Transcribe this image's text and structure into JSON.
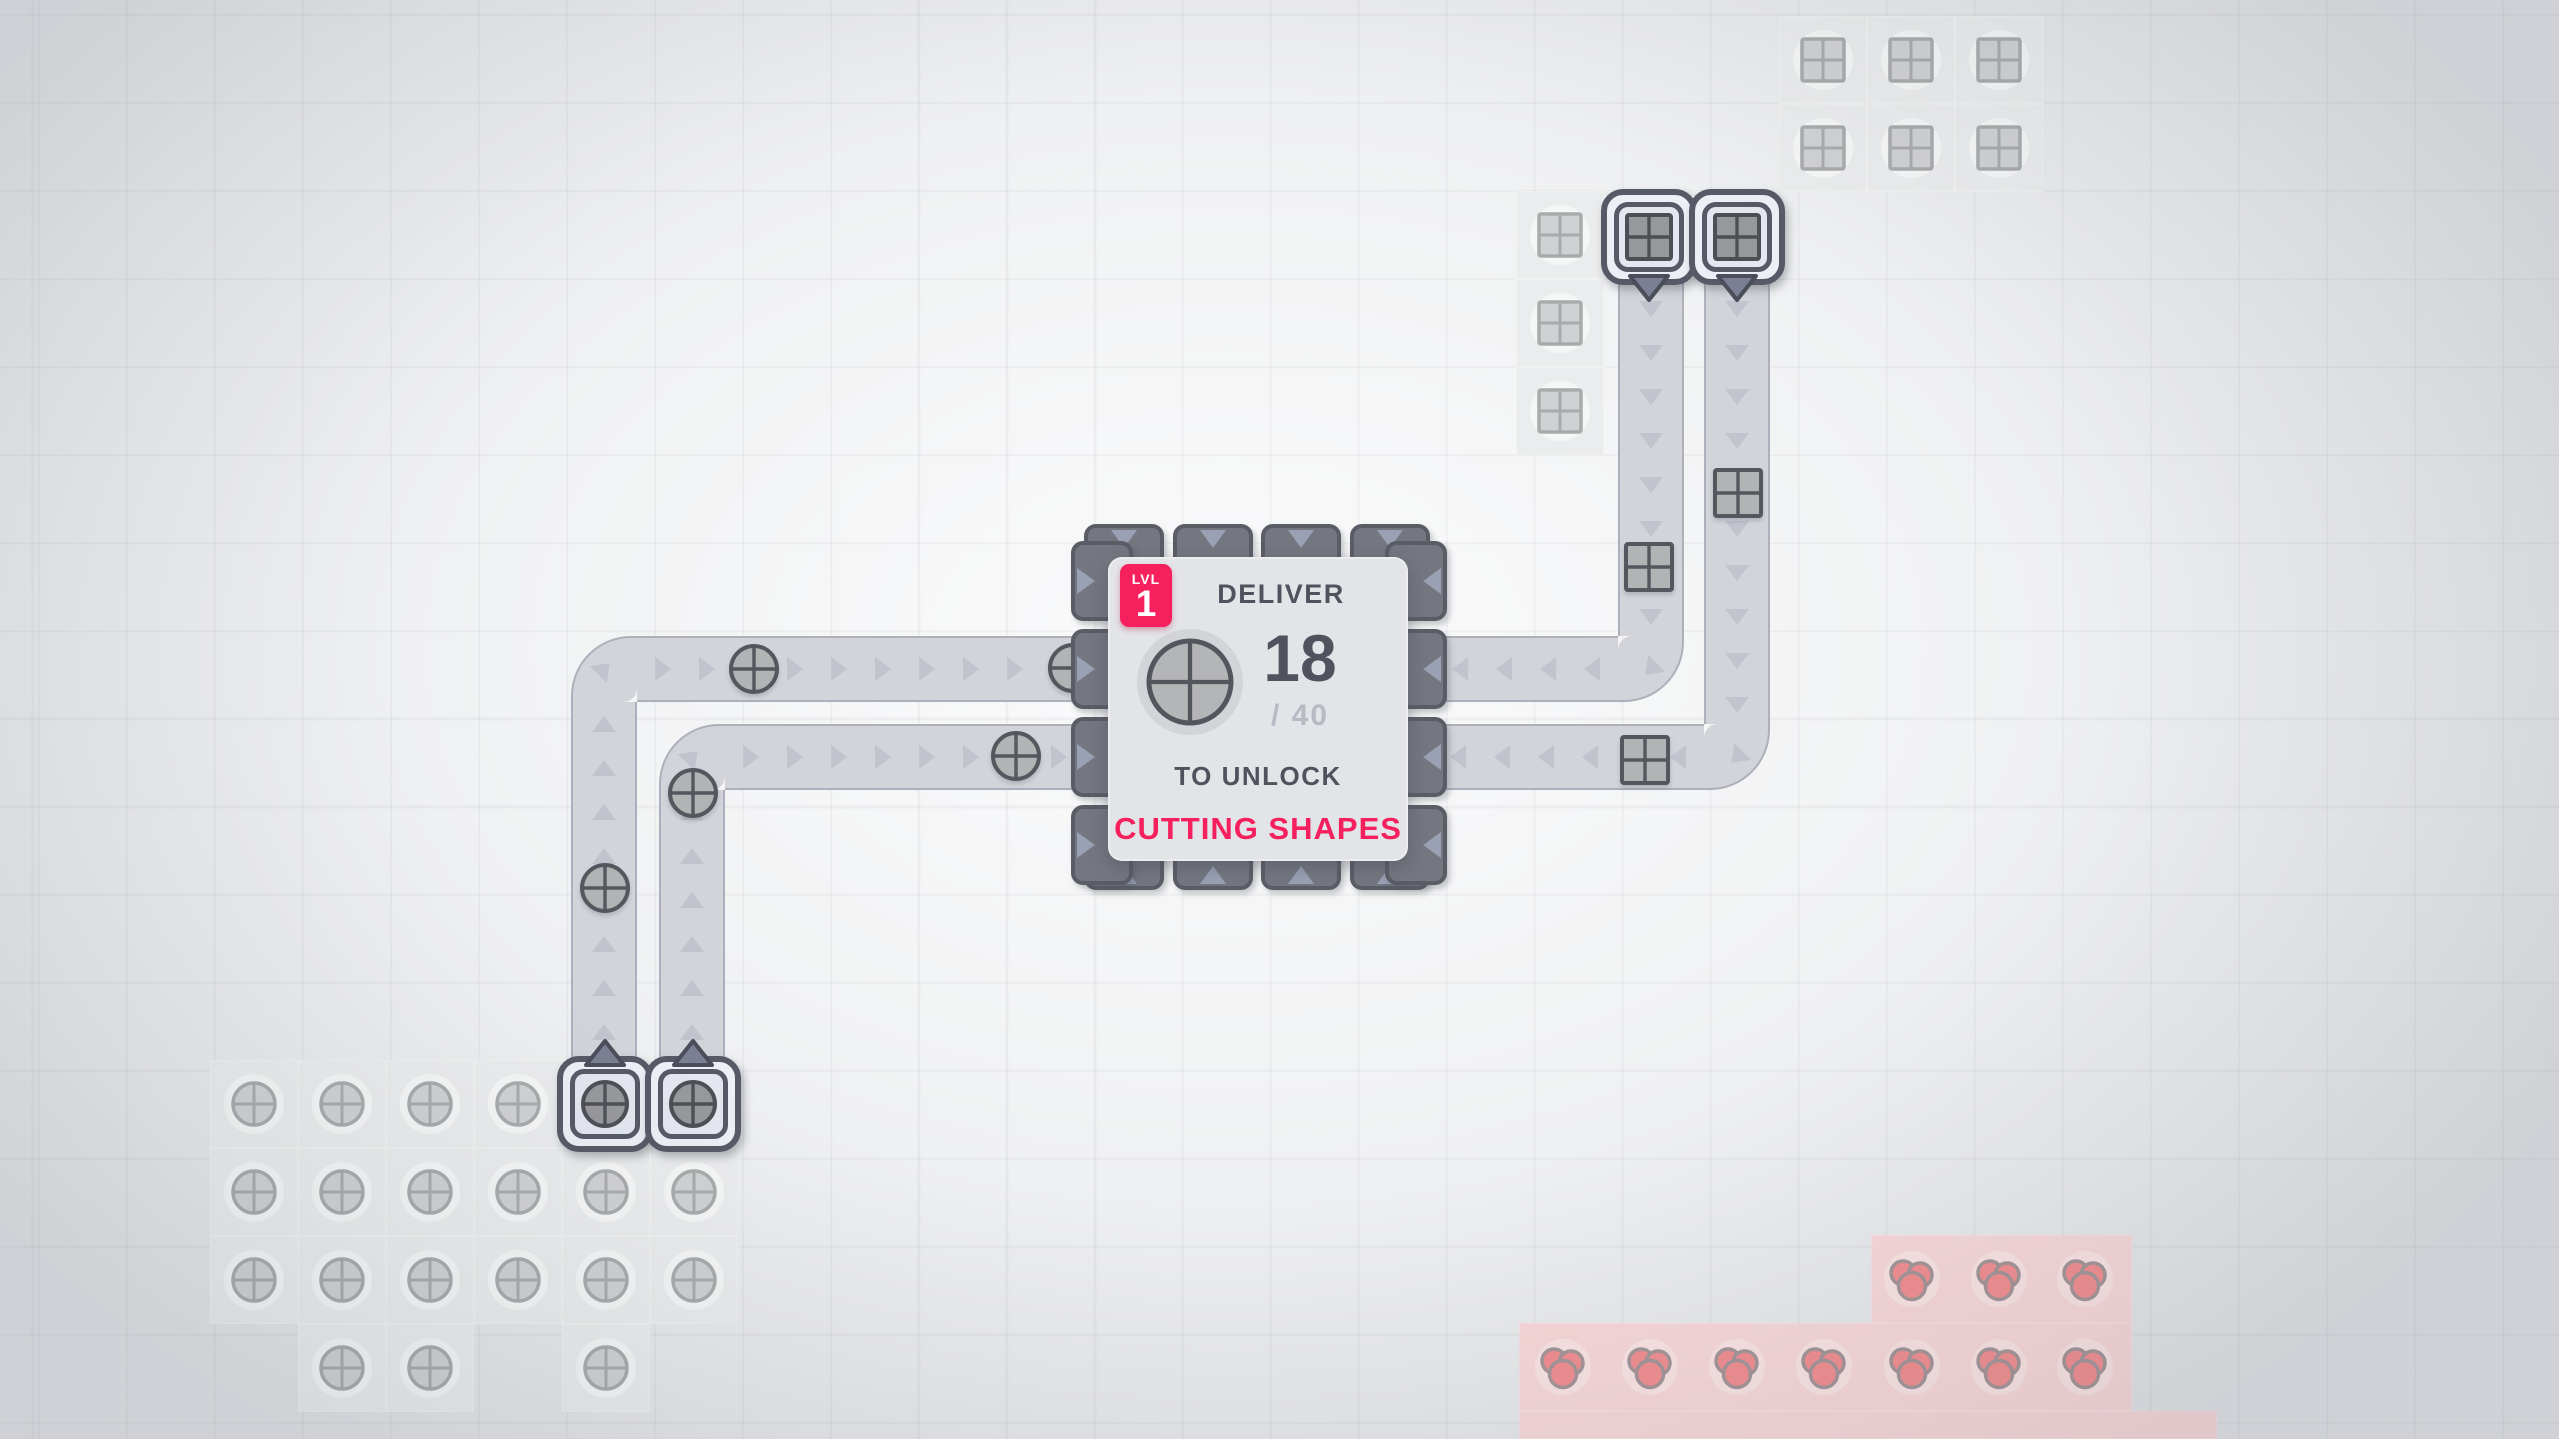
{
  "hub": {
    "level_badge": {
      "label": "LVL",
      "value": "1"
    },
    "title": "DELIVER",
    "delivered": "18",
    "goal": "/ 40",
    "unlock_label": "TO UNLOCK",
    "reward": "CUTTING SHAPES",
    "goal_shape": "circle",
    "panel": {
      "x": 1108,
      "y": 557,
      "w": 300,
      "h": 304
    },
    "slots": {
      "top_xs": [
        1124,
        1213,
        1301,
        1390
      ],
      "side_ys": [
        581,
        669,
        757,
        845
      ],
      "top_y": 524,
      "bottom_y": 828,
      "left_x": 1071,
      "right_x": 1385,
      "w": 80,
      "thickness": 62
    }
  },
  "palette": {
    "accent": "#f6205e",
    "text_dark": "#50535e",
    "text_light": "#b7bac3",
    "belt": "#d2d4da",
    "belt_arrow": "#c1c3cd",
    "slot_fill": "#74777f",
    "slot_arrow": "#9ba1b5",
    "machine_frame": "#565966",
    "item_fill": "#b2b3b5",
    "item_stroke": "#55575e",
    "res_fill": "#d0d1d3",
    "res_stroke": "#a8aaac",
    "ext_res_fill": "#97989b",
    "ext_res_stroke": "#4d4f55",
    "berry_fill": "#f28e90",
    "berry_stroke": "#a39598",
    "tile_gray": "#ebeced",
    "tile_red": "#f8d8d9",
    "shape_bg": "#d2d4d8"
  },
  "belts": {
    "width": 66,
    "strips": [
      {
        "x": 571,
        "y": 702,
        "w": 66,
        "h": 356,
        "dir": "up"
      },
      {
        "x": 637,
        "y": 636,
        "w": 455,
        "h": 66,
        "dir": "right"
      },
      {
        "x": 659,
        "y": 790,
        "w": 66,
        "h": 268,
        "dir": "up"
      },
      {
        "x": 725,
        "y": 724,
        "w": 367,
        "h": 66,
        "dir": "right"
      },
      {
        "x": 1618,
        "y": 283,
        "w": 66,
        "h": 353,
        "dir": "down"
      },
      {
        "x": 1428,
        "y": 636,
        "w": 190,
        "h": 66,
        "dir": "left"
      },
      {
        "x": 1704,
        "y": 283,
        "w": 66,
        "h": 441,
        "dir": "down"
      },
      {
        "x": 1428,
        "y": 724,
        "w": 276,
        "h": 66,
        "dir": "left"
      }
    ],
    "corners": [
      {
        "x": 571,
        "y": 636,
        "round": "tl",
        "angle": 45
      },
      {
        "x": 659,
        "y": 724,
        "round": "tl",
        "angle": 45
      },
      {
        "x": 1618,
        "y": 636,
        "round": "br",
        "angle": 225
      },
      {
        "x": 1704,
        "y": 724,
        "round": "br",
        "angle": 225
      }
    ]
  },
  "items": [
    {
      "type": "circle",
      "x": 754,
      "y": 669
    },
    {
      "type": "circle",
      "x": 1073,
      "y": 668
    },
    {
      "type": "circle",
      "x": 1016,
      "y": 756
    },
    {
      "type": "circle",
      "x": 693,
      "y": 793
    },
    {
      "type": "circle",
      "x": 605,
      "y": 888
    },
    {
      "type": "square",
      "x": 1649,
      "y": 567
    },
    {
      "type": "square",
      "x": 1738,
      "y": 493
    },
    {
      "type": "square",
      "x": 1645,
      "y": 760
    }
  ],
  "resources": {
    "circles": [
      [
        254,
        1104
      ],
      [
        342,
        1104
      ],
      [
        430,
        1104
      ],
      [
        518,
        1104
      ],
      [
        254,
        1192
      ],
      [
        342,
        1192
      ],
      [
        430,
        1192
      ],
      [
        518,
        1192
      ],
      [
        606,
        1192
      ],
      [
        694,
        1192
      ],
      [
        254,
        1280
      ],
      [
        342,
        1280
      ],
      [
        430,
        1280
      ],
      [
        518,
        1280
      ],
      [
        606,
        1280
      ],
      [
        694,
        1280
      ],
      [
        342,
        1368
      ],
      [
        430,
        1368
      ],
      [
        606,
        1368
      ]
    ],
    "squares": [
      [
        1823,
        60
      ],
      [
        1911,
        60
      ],
      [
        1999,
        60
      ],
      [
        1823,
        148
      ],
      [
        1911,
        148
      ],
      [
        1999,
        148
      ],
      [
        1560,
        235
      ],
      [
        1560,
        323
      ],
      [
        1560,
        411
      ]
    ],
    "berries": [
      [
        1912,
        1279
      ],
      [
        1999,
        1279
      ],
      [
        2085,
        1279
      ],
      [
        1563,
        1367
      ],
      [
        1650,
        1367
      ],
      [
        1737,
        1367
      ],
      [
        1824,
        1367
      ],
      [
        1912,
        1367
      ],
      [
        1999,
        1367
      ],
      [
        2085,
        1367
      ]
    ]
  },
  "patches": {
    "gray_cells": [
      [
        254,
        1104
      ],
      [
        342,
        1104
      ],
      [
        430,
        1104
      ],
      [
        518,
        1104
      ],
      [
        605,
        1104
      ],
      [
        693,
        1104
      ],
      [
        254,
        1192
      ],
      [
        342,
        1192
      ],
      [
        430,
        1192
      ],
      [
        518,
        1192
      ],
      [
        606,
        1192
      ],
      [
        694,
        1192
      ],
      [
        254,
        1280
      ],
      [
        342,
        1280
      ],
      [
        430,
        1280
      ],
      [
        518,
        1280
      ],
      [
        606,
        1280
      ],
      [
        694,
        1280
      ],
      [
        342,
        1368
      ],
      [
        430,
        1368
      ],
      [
        606,
        1368
      ],
      [
        1823,
        60
      ],
      [
        1911,
        60
      ],
      [
        1999,
        60
      ],
      [
        1823,
        148
      ],
      [
        1911,
        148
      ],
      [
        1999,
        148
      ],
      [
        1560,
        235
      ],
      [
        1560,
        323
      ],
      [
        1560,
        411
      ],
      [
        1649,
        235
      ],
      [
        1737,
        235
      ]
    ],
    "red_rects": [
      {
        "x": 1871,
        "y": 1235,
        "w": 261,
        "h": 88
      },
      {
        "x": 1519,
        "y": 1323,
        "w": 613,
        "h": 88
      },
      {
        "x": 1519,
        "y": 1411,
        "w": 698,
        "h": 28
      }
    ]
  },
  "extractors": [
    {
      "x": 605,
      "y": 1104,
      "dir": "up",
      "res": "circle"
    },
    {
      "x": 693,
      "y": 1104,
      "dir": "up",
      "res": "circle"
    },
    {
      "x": 1649,
      "y": 237,
      "dir": "down",
      "res": "square"
    },
    {
      "x": 1737,
      "y": 237,
      "dir": "down",
      "res": "square"
    }
  ]
}
